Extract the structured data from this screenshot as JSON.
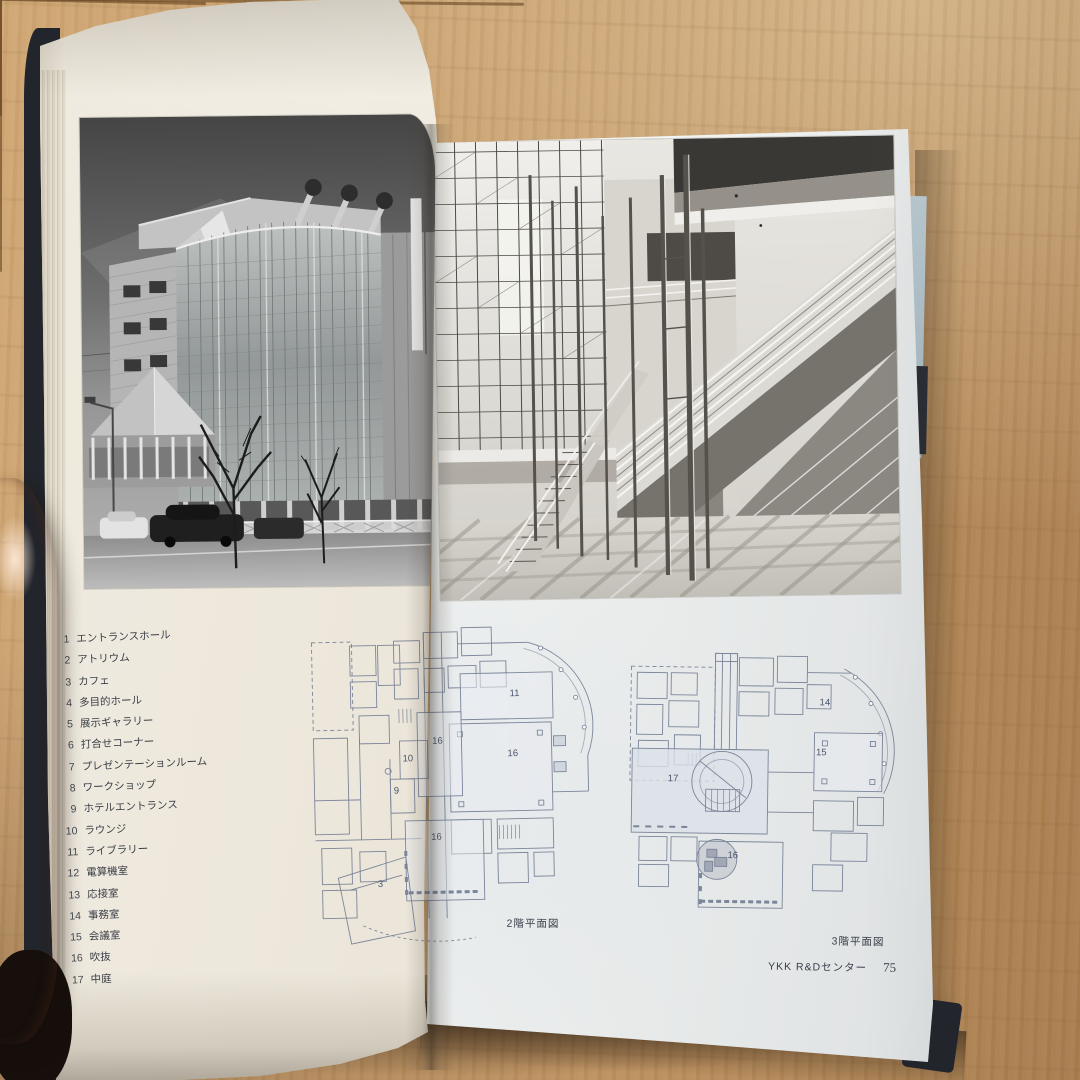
{
  "book": {
    "running_header": "YKK R&D",
    "left_page": {
      "page_number": "74",
      "legend": [
        {
          "num": "1",
          "label": "エントランスホール"
        },
        {
          "num": "2",
          "label": "アトリウム"
        },
        {
          "num": "3",
          "label": "カフェ"
        },
        {
          "num": "4",
          "label": "多目的ホール"
        },
        {
          "num": "5",
          "label": "展示ギャラリー"
        },
        {
          "num": "6",
          "label": "打合せコーナー"
        },
        {
          "num": "7",
          "label": "プレゼンテーションルーム"
        },
        {
          "num": "8",
          "label": "ワークショップ"
        },
        {
          "num": "9",
          "label": "ホテルエントランス"
        },
        {
          "num": "10",
          "label": "ラウンジ"
        },
        {
          "num": "11",
          "label": "ライブラリー"
        },
        {
          "num": "12",
          "label": "電算機室"
        },
        {
          "num": "13",
          "label": "応接室"
        },
        {
          "num": "14",
          "label": "事務室"
        },
        {
          "num": "15",
          "label": "会議室"
        },
        {
          "num": "16",
          "label": "吹抜"
        },
        {
          "num": "17",
          "label": "中庭"
        }
      ]
    },
    "right_page": {
      "caption_2f": "2階平面図",
      "caption_3f": "3階平面図",
      "footer_title": "YKK R&Dセンター",
      "page_number": "75",
      "plan_2f_labels": [
        {
          "text": "11",
          "x": 72,
          "y": 30
        },
        {
          "text": "16",
          "x": 71,
          "y": 47
        },
        {
          "text": "16",
          "x": 46,
          "y": 43
        },
        {
          "text": "10",
          "x": 36,
          "y": 48
        },
        {
          "text": "9",
          "x": 32,
          "y": 57
        },
        {
          "text": "16",
          "x": 45,
          "y": 70
        },
        {
          "text": "3",
          "x": 26,
          "y": 83
        }
      ],
      "plan_3f_labels": [
        {
          "text": "14",
          "x": 71,
          "y": 25
        },
        {
          "text": "15",
          "x": 70,
          "y": 43
        },
        {
          "text": "17",
          "x": 19,
          "y": 53
        },
        {
          "text": "16",
          "x": 40,
          "y": 80
        }
      ]
    }
  },
  "colors": {
    "floor_wood": "#c79d6b",
    "page_left_paper": "#ece6da",
    "page_right_paper": "#edefee",
    "cover": "#22252b",
    "fore_edge_blue": "#a9bcc5",
    "plan_line": "#727d94"
  }
}
